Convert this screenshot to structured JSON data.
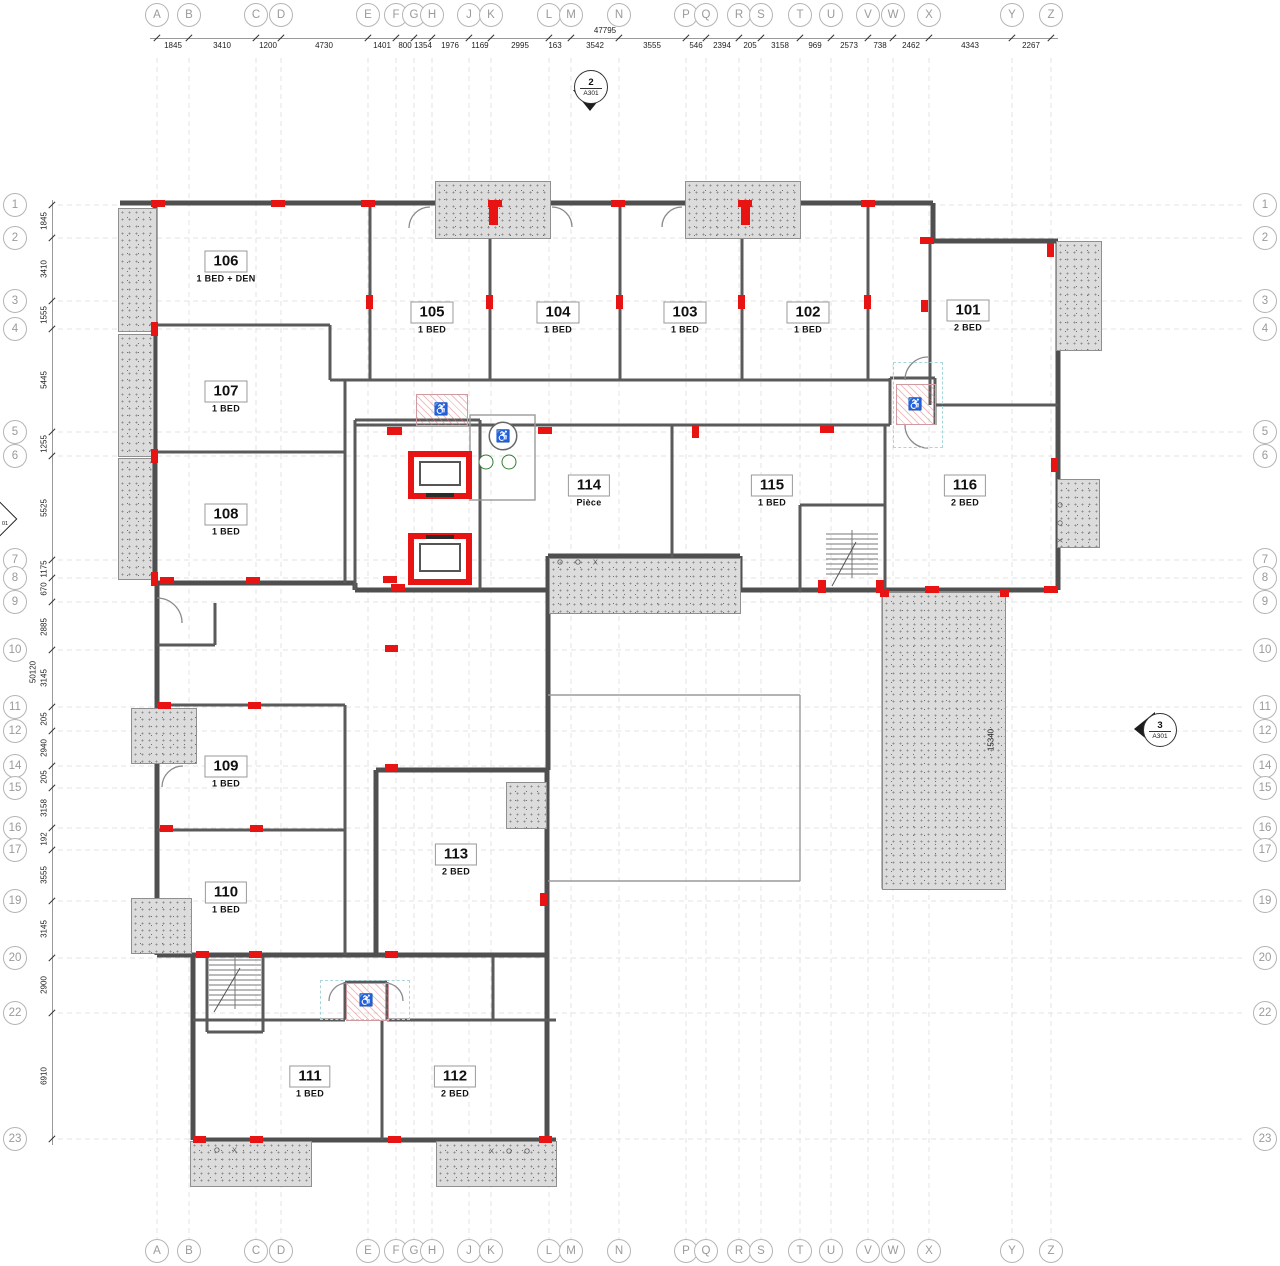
{
  "grid": {
    "letters": [
      {
        "label": "A",
        "x": 157
      },
      {
        "label": "B",
        "x": 189
      },
      {
        "label": "C",
        "x": 256
      },
      {
        "label": "D",
        "x": 281
      },
      {
        "label": "E",
        "x": 368
      },
      {
        "label": "F",
        "x": 396
      },
      {
        "label": "G",
        "x": 414
      },
      {
        "label": "H",
        "x": 432
      },
      {
        "label": "J",
        "x": 469
      },
      {
        "label": "K",
        "x": 491
      },
      {
        "label": "L",
        "x": 549
      },
      {
        "label": "M",
        "x": 571
      },
      {
        "label": "N",
        "x": 619
      },
      {
        "label": "P",
        "x": 686
      },
      {
        "label": "Q",
        "x": 706
      },
      {
        "label": "R",
        "x": 739
      },
      {
        "label": "S",
        "x": 761
      },
      {
        "label": "T",
        "x": 800
      },
      {
        "label": "U",
        "x": 831
      },
      {
        "label": "V",
        "x": 868
      },
      {
        "label": "W",
        "x": 893
      },
      {
        "label": "X",
        "x": 929
      },
      {
        "label": "Y",
        "x": 1012
      },
      {
        "label": "Z",
        "x": 1051
      }
    ],
    "rows": [
      {
        "label": "1",
        "y": 205
      },
      {
        "label": "2",
        "y": 238
      },
      {
        "label": "3",
        "y": 301
      },
      {
        "label": "4",
        "y": 329
      },
      {
        "label": "5",
        "y": 432
      },
      {
        "label": "6",
        "y": 456
      },
      {
        "label": "7",
        "y": 560
      },
      {
        "label": "8",
        "y": 578
      },
      {
        "label": "9",
        "y": 602
      },
      {
        "label": "10",
        "y": 650
      },
      {
        "label": "11",
        "y": 707
      },
      {
        "label": "12",
        "y": 731
      },
      {
        "label": "14",
        "y": 766
      },
      {
        "label": "15",
        "y": 788
      },
      {
        "label": "16",
        "y": 828
      },
      {
        "label": "17",
        "y": 850
      },
      {
        "label": "19",
        "y": 901
      },
      {
        "label": "20",
        "y": 958
      },
      {
        "label": "22",
        "y": 1013
      },
      {
        "label": "23",
        "y": 1139
      }
    ],
    "top_total": "47795",
    "top_segments": [
      {
        "v": "1845",
        "x": 173
      },
      {
        "v": "3410",
        "x": 222
      },
      {
        "v": "1200",
        "x": 268
      },
      {
        "v": "4730",
        "x": 324
      },
      {
        "v": "1401",
        "x": 382
      },
      {
        "v": "800",
        "x": 405
      },
      {
        "v": "1354",
        "x": 423
      },
      {
        "v": "1976",
        "x": 450
      },
      {
        "v": "1169",
        "x": 480
      },
      {
        "v": "2995",
        "x": 520
      },
      {
        "v": "163",
        "x": 555
      },
      {
        "v": "3542",
        "x": 595
      },
      {
        "v": "3555",
        "x": 652
      },
      {
        "v": "546",
        "x": 696
      },
      {
        "v": "2394",
        "x": 722
      },
      {
        "v": "205",
        "x": 750
      },
      {
        "v": "3158",
        "x": 780
      },
      {
        "v": "969",
        "x": 815
      },
      {
        "v": "2573",
        "x": 849
      },
      {
        "v": "738",
        "x": 880
      },
      {
        "v": "2462",
        "x": 911
      },
      {
        "v": "4343",
        "x": 970
      },
      {
        "v": "2267",
        "x": 1031
      }
    ],
    "left_total": "50120",
    "left_segments": [
      {
        "v": "1845",
        "y": 221
      },
      {
        "v": "3410",
        "y": 269
      },
      {
        "v": "1555",
        "y": 315
      },
      {
        "v": "5445",
        "y": 380
      },
      {
        "v": "1255",
        "y": 444
      },
      {
        "v": "5525",
        "y": 508
      },
      {
        "v": "1175",
        "y": 569
      },
      {
        "v": "670",
        "y": 589
      },
      {
        "v": "2885",
        "y": 627
      },
      {
        "v": "3145",
        "y": 678
      },
      {
        "v": "205",
        "y": 719
      },
      {
        "v": "2940",
        "y": 748
      },
      {
        "v": "205",
        "y": 777
      },
      {
        "v": "3158",
        "y": 808
      },
      {
        "v": "192",
        "y": 839
      },
      {
        "v": "3555",
        "y": 875
      },
      {
        "v": "3145",
        "y": 929
      },
      {
        "v": "2900",
        "y": 985
      },
      {
        "v": "6910",
        "y": 1076
      }
    ]
  },
  "rooms": [
    {
      "num": "101",
      "type": "2 BED",
      "x": 968,
      "y": 316
    },
    {
      "num": "102",
      "type": "1 BED",
      "x": 808,
      "y": 318
    },
    {
      "num": "103",
      "type": "1 BED",
      "x": 685,
      "y": 318
    },
    {
      "num": "104",
      "type": "1 BED",
      "x": 558,
      "y": 318
    },
    {
      "num": "105",
      "type": "1 BED",
      "x": 432,
      "y": 318
    },
    {
      "num": "106",
      "type": "1 BED + DEN",
      "x": 226,
      "y": 267
    },
    {
      "num": "107",
      "type": "1 BED",
      "x": 226,
      "y": 397
    },
    {
      "num": "108",
      "type": "1 BED",
      "x": 226,
      "y": 520
    },
    {
      "num": "109",
      "type": "1 BED",
      "x": 226,
      "y": 772
    },
    {
      "num": "110",
      "type": "1 BED",
      "x": 226,
      "y": 898
    },
    {
      "num": "111",
      "type": "1 BED",
      "x": 310,
      "y": 1082
    },
    {
      "num": "112",
      "type": "2 BED",
      "x": 455,
      "y": 1082
    },
    {
      "num": "113",
      "type": "2 BED",
      "x": 456,
      "y": 860
    },
    {
      "num": "114",
      "type": "Pièce",
      "x": 589,
      "y": 491
    },
    {
      "num": "115",
      "type": "1 BED",
      "x": 772,
      "y": 491
    },
    {
      "num": "116",
      "type": "2 BED",
      "x": 965,
      "y": 491
    }
  ],
  "section_markers": {
    "top": {
      "num": "2",
      "sheet": "A301",
      "x": 590,
      "y": 86
    },
    "right": {
      "num": "3",
      "sheet": "A301",
      "x": 1159,
      "y": 729
    },
    "left_partial": {
      "text": "01"
    }
  },
  "terrace_dim": {
    "v": "15340",
    "x": 991,
    "y": 740
  },
  "window_marks": [
    {
      "t": "O O X",
      "x": 580,
      "y": 562,
      "vert": false
    },
    {
      "t": "O X",
      "x": 228,
      "y": 1150,
      "vert": false
    },
    {
      "t": "X O O",
      "x": 512,
      "y": 1151,
      "vert": false
    },
    {
      "t": "X O O",
      "x": 1060,
      "y": 520,
      "vert": true
    }
  ],
  "accessible_icons": [
    {
      "x": 441,
      "y": 409,
      "circled": false
    },
    {
      "x": 503,
      "y": 436,
      "circled": true
    },
    {
      "x": 915,
      "y": 404,
      "circled": false
    },
    {
      "x": 366,
      "y": 1000,
      "circled": false
    }
  ],
  "balconies": [
    [
      435,
      181,
      114,
      56
    ],
    [
      685,
      181,
      114,
      56
    ],
    [
      118,
      208,
      37,
      122
    ],
    [
      118,
      334,
      34,
      121
    ],
    [
      118,
      458,
      33,
      120
    ],
    [
      1056,
      241,
      44,
      108
    ],
    [
      1057,
      479,
      41,
      67
    ],
    [
      549,
      558,
      190,
      54
    ],
    [
      882,
      592,
      122,
      296
    ],
    [
      131,
      708,
      64,
      54
    ],
    [
      131,
      898,
      59,
      54
    ],
    [
      506,
      782,
      39,
      45
    ],
    [
      190,
      1141,
      120,
      44
    ],
    [
      436,
      1141,
      119,
      44
    ]
  ],
  "red_markers": [
    [
      151,
      200,
      14,
      7
    ],
    [
      271,
      200,
      14,
      7
    ],
    [
      361,
      200,
      14,
      7
    ],
    [
      488,
      200,
      14,
      7
    ],
    [
      611,
      200,
      14,
      7
    ],
    [
      738,
      200,
      14,
      7
    ],
    [
      861,
      200,
      14,
      7
    ],
    [
      489,
      205,
      9,
      20
    ],
    [
      741,
      205,
      9,
      20
    ],
    [
      920,
      237,
      14,
      7
    ],
    [
      1047,
      243,
      7,
      14
    ],
    [
      151,
      322,
      7,
      14
    ],
    [
      151,
      449,
      7,
      14
    ],
    [
      151,
      572,
      7,
      14
    ],
    [
      366,
      295,
      7,
      14
    ],
    [
      486,
      295,
      7,
      14
    ],
    [
      616,
      295,
      7,
      14
    ],
    [
      738,
      295,
      7,
      14
    ],
    [
      864,
      295,
      7,
      14
    ],
    [
      921,
      300,
      7,
      12
    ],
    [
      387,
      427,
      15,
      8
    ],
    [
      538,
      427,
      14,
      7
    ],
    [
      692,
      425,
      7,
      13
    ],
    [
      820,
      426,
      14,
      7
    ],
    [
      1051,
      458,
      7,
      14
    ],
    [
      160,
      577,
      14,
      7
    ],
    [
      246,
      577,
      14,
      7
    ],
    [
      383,
      576,
      14,
      7
    ],
    [
      391,
      584,
      14,
      7
    ],
    [
      818,
      580,
      8,
      13
    ],
    [
      876,
      580,
      8,
      13
    ],
    [
      925,
      586,
      14,
      7
    ],
    [
      1044,
      586,
      14,
      7
    ],
    [
      880,
      589,
      9,
      8
    ],
    [
      1000,
      589,
      9,
      8
    ],
    [
      158,
      702,
      13,
      7
    ],
    [
      248,
      702,
      13,
      7
    ],
    [
      385,
      645,
      13,
      7
    ],
    [
      385,
      764,
      13,
      7
    ],
    [
      160,
      825,
      13,
      7
    ],
    [
      250,
      825,
      13,
      7
    ],
    [
      196,
      951,
      13,
      7
    ],
    [
      249,
      951,
      13,
      7
    ],
    [
      385,
      951,
      13,
      7
    ],
    [
      540,
      893,
      7,
      13
    ],
    [
      193,
      1136,
      13,
      7
    ],
    [
      250,
      1136,
      13,
      7
    ],
    [
      388,
      1136,
      13,
      7
    ],
    [
      539,
      1136,
      13,
      7
    ]
  ],
  "pink_zones": [
    [
      416,
      394,
      50,
      30
    ],
    [
      896,
      384,
      38,
      39
    ],
    [
      346,
      983,
      41,
      36
    ]
  ],
  "cyan_zones": [
    [
      893,
      362,
      48,
      84
    ],
    [
      320,
      980,
      88,
      38
    ]
  ],
  "green_fixtures": [
    [
      486,
      462
    ],
    [
      509,
      462
    ]
  ],
  "elevators": [
    [
      408,
      451,
      64,
      48
    ],
    [
      408,
      533,
      64,
      52
    ]
  ]
}
